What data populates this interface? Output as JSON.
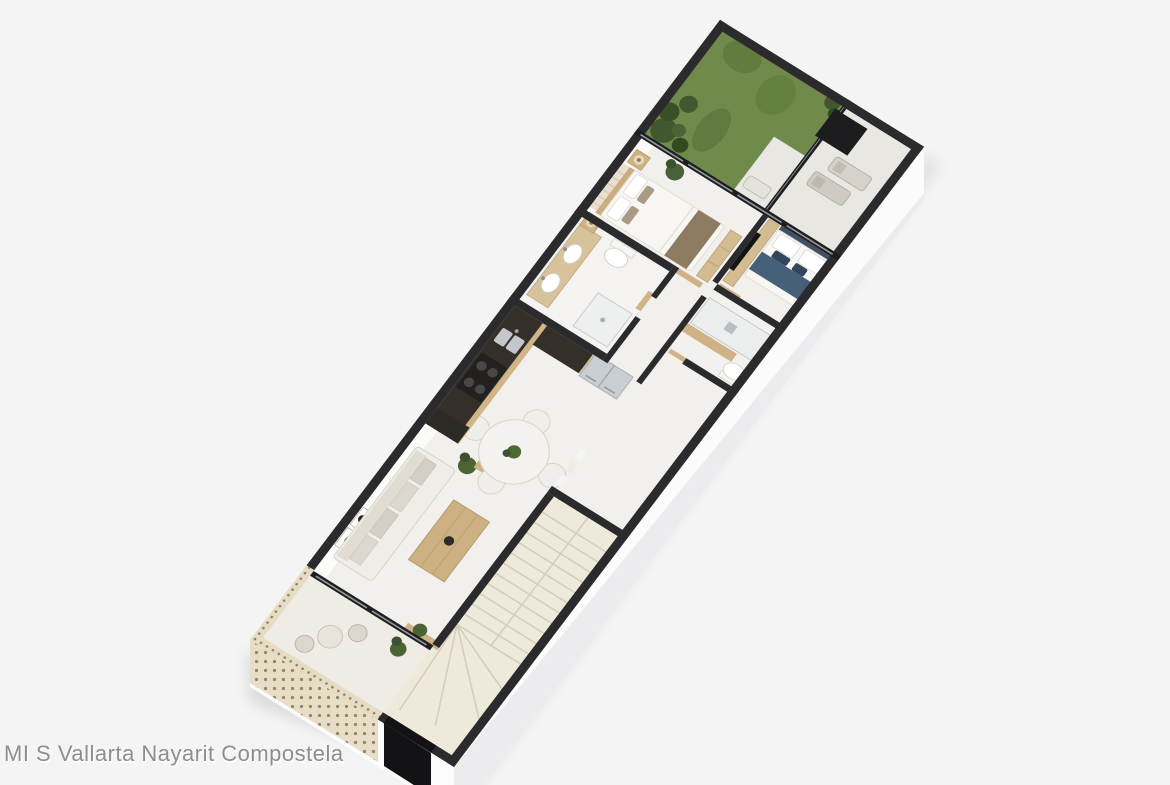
{
  "watermark": {
    "text": "MI S Vallarta Nayarit Compostela"
  },
  "scene": {
    "description": "3D isometric cutaway floor plan render of a two-level apartment unit, rotated diagonally on a light gray background",
    "background_color": "#f4f4f5",
    "palette": {
      "wall_top": "#2b2a2c",
      "floor": "#f2f0ed",
      "terrace_tile": "#e9e7e2",
      "steps": "#efe9dc",
      "wood_light": "#d8c29b",
      "wood_mid": "#cfb285",
      "counter_dark": "#352f29",
      "grass": "#6f8a4a",
      "bush": "#41582f",
      "lattice": "#e6dcc4",
      "glass_frame": "#1f1f22",
      "navy_accent": "#46607a",
      "tan_accent": "#8c7b61",
      "exterior_face": "#fdfdfd",
      "front_door": "#131315"
    },
    "rooms": [
      {
        "name": "balcony-with-lattice-screen"
      },
      {
        "name": "entry-front-door"
      },
      {
        "name": "staircase"
      },
      {
        "name": "living-room"
      },
      {
        "name": "dining-area"
      },
      {
        "name": "kitchen"
      },
      {
        "name": "main-bathroom"
      },
      {
        "name": "hallway"
      },
      {
        "name": "ensuite-bathroom"
      },
      {
        "name": "master-bedroom"
      },
      {
        "name": "second-bedroom"
      },
      {
        "name": "terrace-garden"
      }
    ]
  }
}
